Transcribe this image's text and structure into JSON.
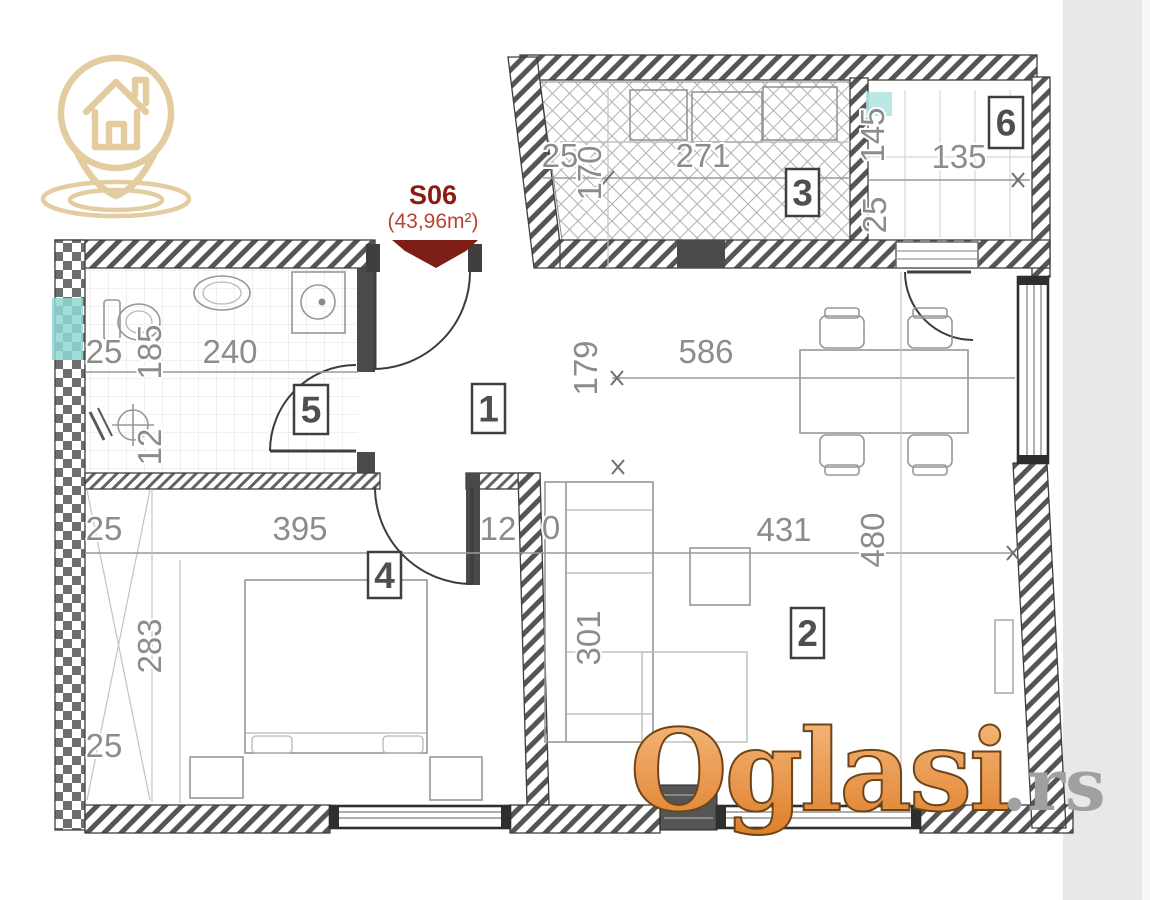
{
  "unit_label": {
    "code": "S06",
    "area": "(43,96m²)"
  },
  "watermark": {
    "main": "Oglasi",
    "suffix": ".rs"
  },
  "room_labels": [
    {
      "num": "1",
      "x": 472,
      "y": 384,
      "w": 33,
      "h": 49
    },
    {
      "num": "2",
      "x": 791,
      "y": 608,
      "w": 33,
      "h": 50
    },
    {
      "num": "3",
      "x": 786,
      "y": 169,
      "w": 33,
      "h": 47
    },
    {
      "num": "4",
      "x": 368,
      "y": 552,
      "w": 33,
      "h": 46
    },
    {
      "num": "5",
      "x": 294,
      "y": 385,
      "w": 34,
      "h": 49
    },
    {
      "num": "6",
      "x": 989,
      "y": 97,
      "w": 34,
      "h": 51
    }
  ],
  "dimensions": [
    {
      "text": "25",
      "x": 560,
      "y": 167,
      "rot": 0
    },
    {
      "text": "170",
      "x": 601,
      "y": 173,
      "rot": -90
    },
    {
      "text": "271",
      "x": 703,
      "y": 167,
      "rot": 0
    },
    {
      "text": "145",
      "x": 884,
      "y": 135,
      "rot": -90
    },
    {
      "text": "135",
      "x": 959,
      "y": 168,
      "rot": 0
    },
    {
      "text": "25",
      "x": 886,
      "y": 215,
      "rot": -90
    },
    {
      "text": "25",
      "x": 104,
      "y": 363,
      "rot": 0
    },
    {
      "text": "185",
      "x": 161,
      "y": 352,
      "rot": -90
    },
    {
      "text": "240",
      "x": 230,
      "y": 363,
      "rot": 0
    },
    {
      "text": "12",
      "x": 161,
      "y": 447,
      "rot": -90
    },
    {
      "text": "179",
      "x": 597,
      "y": 368,
      "rot": -90
    },
    {
      "text": "586",
      "x": 706,
      "y": 363,
      "rot": 0
    },
    {
      "text": "25",
      "x": 104,
      "y": 540,
      "rot": 0
    },
    {
      "text": "395",
      "x": 300,
      "y": 540,
      "rot": 0
    },
    {
      "text": "12",
      "x": 498,
      "y": 540,
      "rot": 0
    },
    {
      "text": "0",
      "x": 551,
      "y": 539,
      "rot": 0
    },
    {
      "text": "431",
      "x": 784,
      "y": 541,
      "rot": 0
    },
    {
      "text": "480",
      "x": 884,
      "y": 540,
      "rot": -90
    },
    {
      "text": "301",
      "x": 600,
      "y": 638,
      "rot": -90
    },
    {
      "text": "283",
      "x": 161,
      "y": 646,
      "rot": -90
    },
    {
      "text": "25",
      "x": 104,
      "y": 757,
      "rot": 0
    }
  ],
  "colors": {
    "accent_red": "#8e1b12",
    "ribbon_red": "#7d1f17",
    "watermark_orange_top": "#f7bb80",
    "watermark_orange_bottom": "#dd7f2a",
    "watermark_gray": "#a0a0a0",
    "logo_tan": "#e3cda0",
    "teal_marker": "#8fd8d4",
    "wall_dark": "#4a4a4a"
  }
}
